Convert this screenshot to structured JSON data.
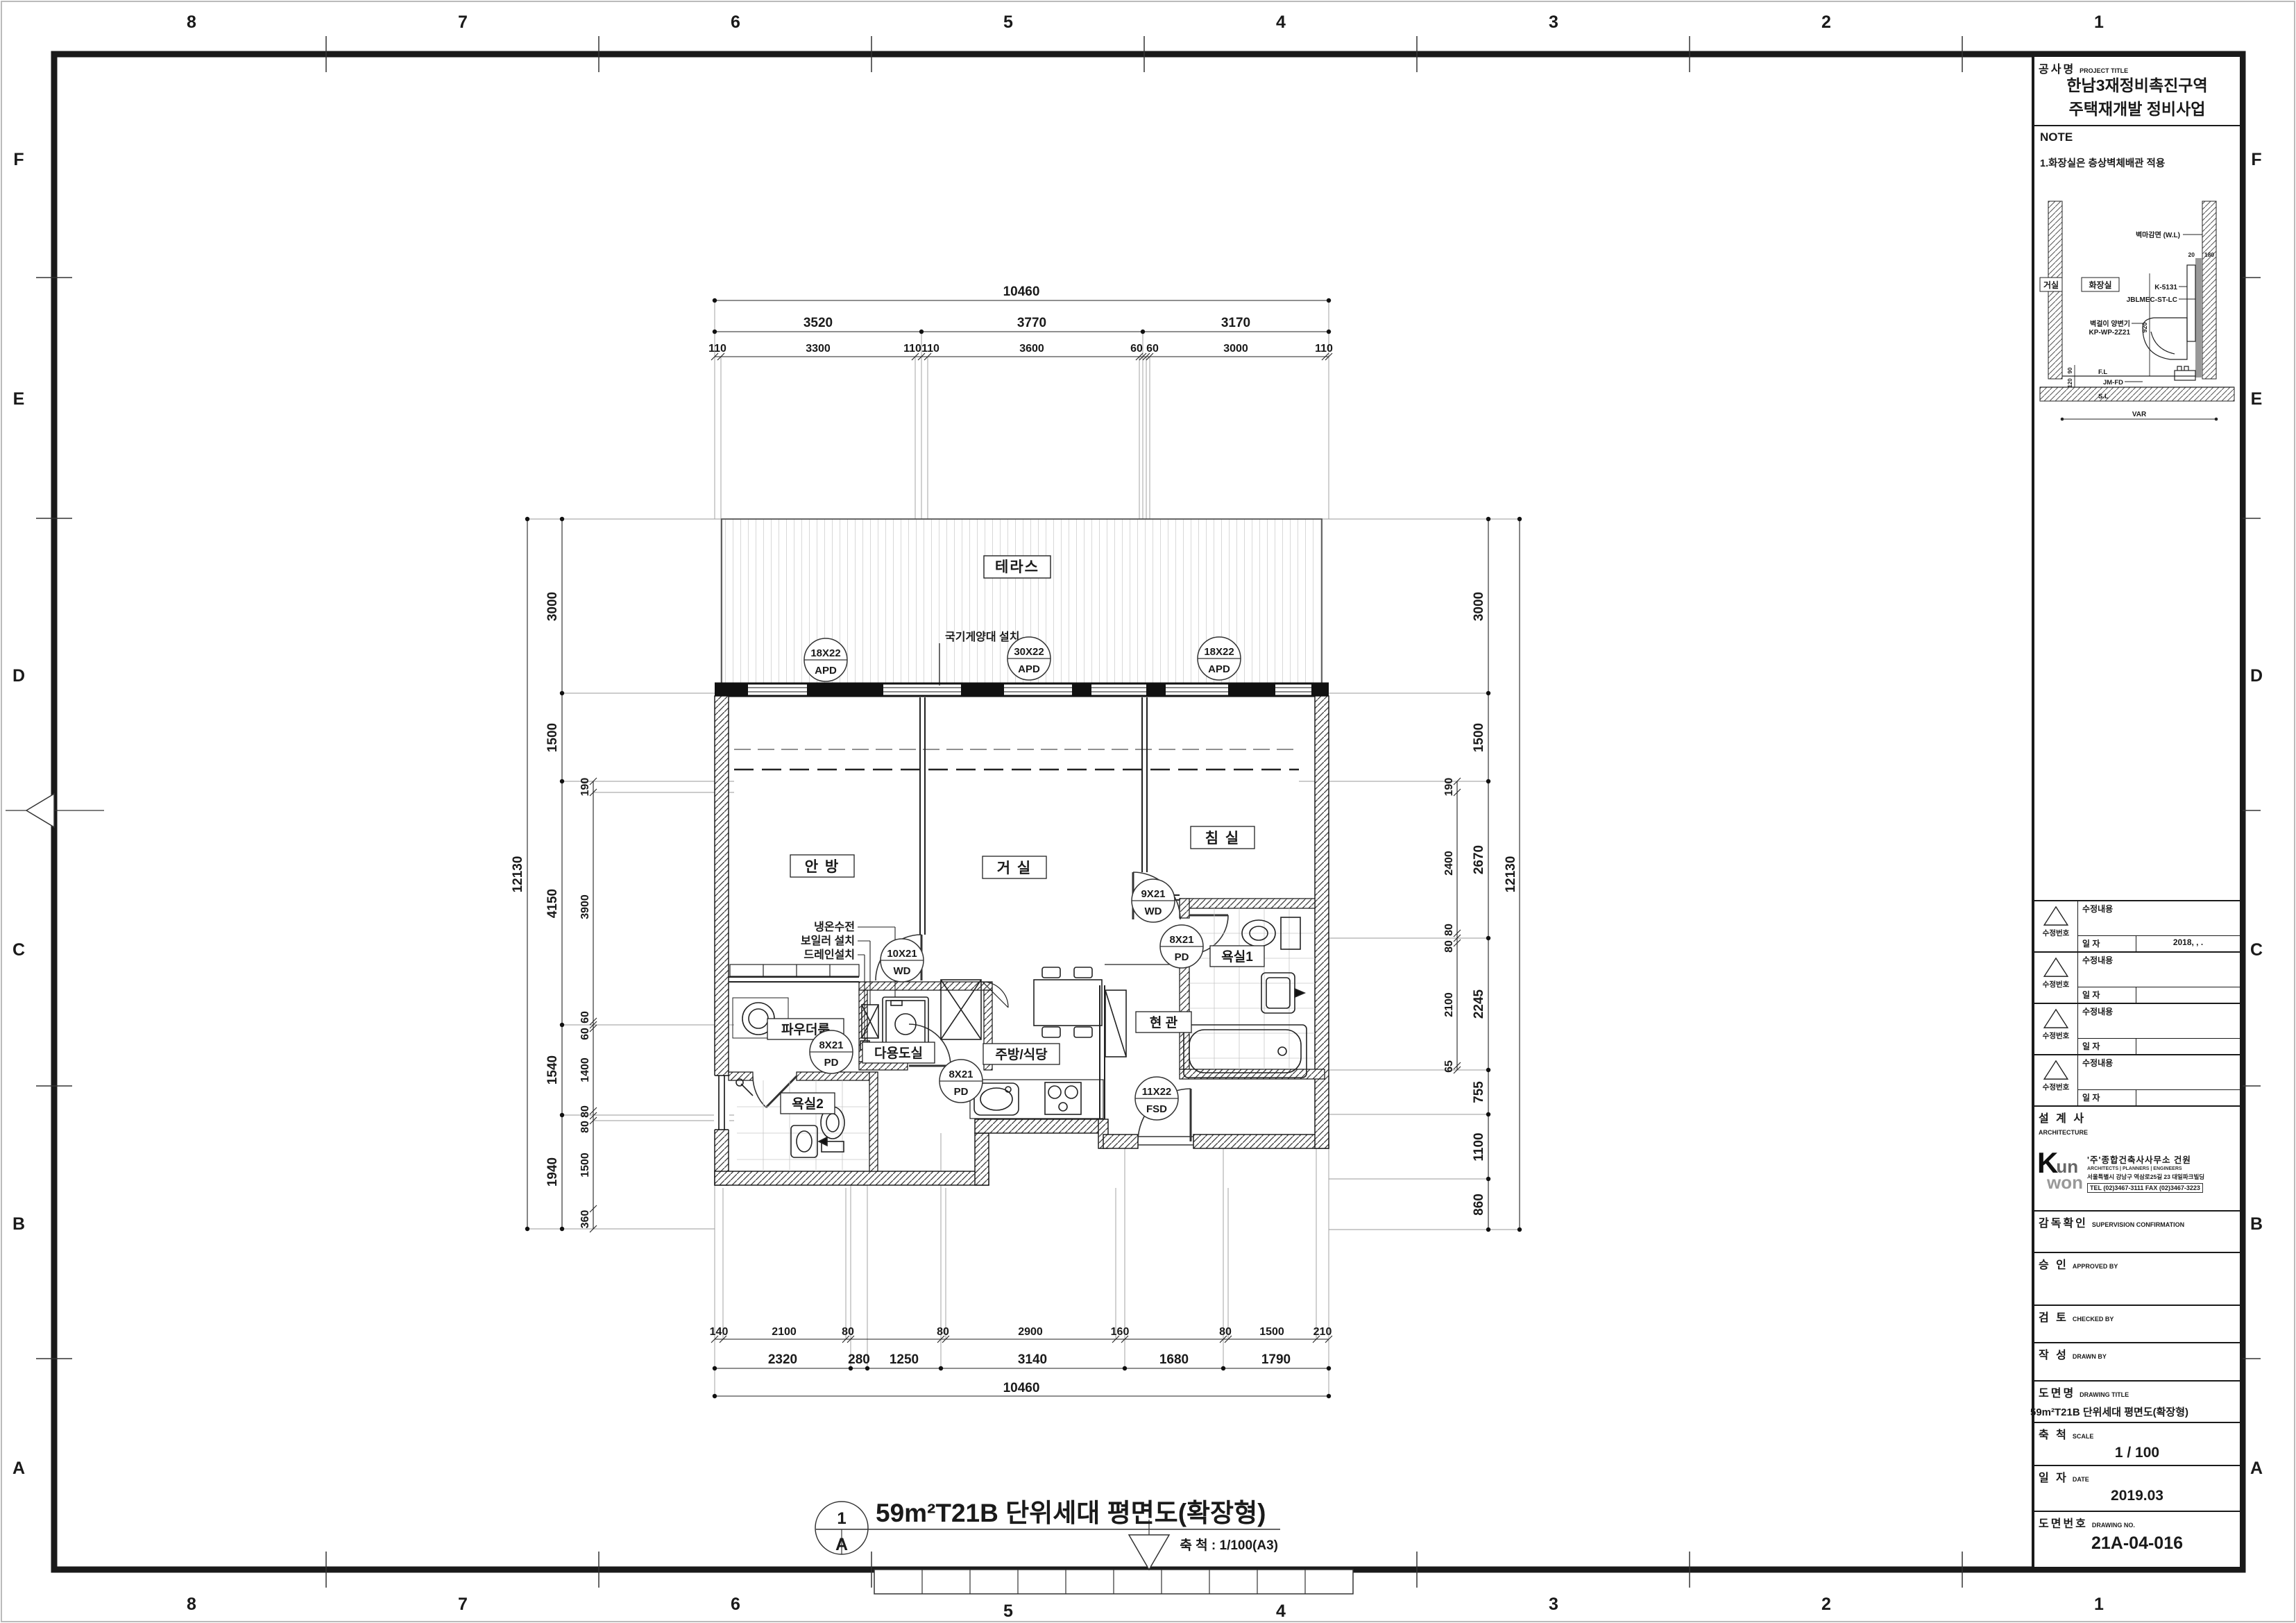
{
  "sheet": {
    "bg": "#ffffff",
    "line": "#1a1a1a"
  },
  "grid": {
    "cols": [
      "8",
      "7",
      "6",
      "5",
      "4",
      "3",
      "2",
      "1"
    ],
    "rows": [
      "F",
      "E",
      "D",
      "C",
      "B",
      "A"
    ]
  },
  "plan": {
    "rooms": {
      "terrace": "테라스",
      "master": "안 방",
      "living": "거 실",
      "bedroom": "침 실",
      "bath1": "욕실1",
      "bath2": "욕실2",
      "entrance": "현 관",
      "kitchen": "주방/식당",
      "utility": "다용도실",
      "powder": "파우더룸"
    },
    "annotations": {
      "flagpole": "국기게양대 설치",
      "line1": "냉온수전",
      "line2": "보일러 설치",
      "line3": "드레인설치"
    },
    "tags": [
      {
        "size": "18X22",
        "type": "APD"
      },
      {
        "size": "30X22",
        "type": "APD"
      },
      {
        "size": "18X22",
        "type": "APD"
      },
      {
        "size": "10X21",
        "type": "WD"
      },
      {
        "size": "8X21",
        "type": "PD"
      },
      {
        "size": "8X21",
        "type": "PD"
      },
      {
        "size": "9X21",
        "type": "WD"
      },
      {
        "size": "8X21",
        "type": "PD"
      },
      {
        "size": "11X22",
        "type": "FSD"
      }
    ],
    "dims": {
      "t1": "10460",
      "t2": [
        "3520",
        "3770",
        "3170"
      ],
      "t3": [
        "110",
        "3300",
        "110",
        "110",
        "3600",
        "60",
        "60",
        "3000",
        "110"
      ],
      "b1": [
        "140",
        "2100",
        "80",
        "80",
        "2900",
        "160",
        "80",
        "1500",
        "210"
      ],
      "b2": [
        "2320",
        "280",
        "1250",
        "3140",
        "1680",
        "1790"
      ],
      "b3": "10460",
      "l1": "12130",
      "l2": [
        "3000",
        "1500",
        "4150",
        "1540",
        "1940"
      ],
      "l3": [
        "190",
        "3900",
        "60",
        "60",
        "1400",
        "80",
        "80",
        "1500",
        "360"
      ],
      "r1": [
        "190",
        "2400",
        "80",
        "80",
        "2100",
        "65"
      ],
      "r2": [
        "3000",
        "1500",
        "2670",
        "2245",
        "755",
        "1100",
        "860"
      ],
      "r3": "12130"
    }
  },
  "view": {
    "number": "1",
    "letter": "A",
    "title": "59m²T21B 단위세대 평면도(확장형)",
    "scale": "축 척 : 1/100(A3)"
  },
  "title_block": {
    "project_label": "공사명",
    "project_label_en": "PROJECT TITLE",
    "project_line1": "한남3재정비촉진구역",
    "project_line2": "주택재개발 정비사업",
    "note_label": "NOTE",
    "note_1": "1.화장실은 층상벽체배관 적용",
    "detail": {
      "room_left": "거실",
      "room_right": "화장실",
      "wall_finish": "벽마감면 (W.L)",
      "model_1": "K-5131",
      "model_2": "JBLMEC-ST-LC",
      "toilet_1": "벽걸이 양변기",
      "toilet_2": "KP-WP-2Z21",
      "fl": "F.L",
      "sl": "S.L",
      "drain": "JM-FD",
      "d20": "20",
      "d180": "180",
      "d920": "920",
      "d90": "90",
      "d120": "120",
      "dvar": "VAR"
    },
    "rev_no_label": "수정번호",
    "rev_content_label": "수정내용",
    "rev_date_label": "일  자",
    "rev_date_1": "2018,      ,      .",
    "architect_label": "설 계 사",
    "architect_en": "ARCHITECTURE",
    "firm_logo_k": "K",
    "firm_logo_un": "un",
    "firm_logo_won": "won",
    "firm_name": "'주'종합건축사사무소 건원",
    "firm_type": "ARCHITECTS   |   PLANNERS   |   ENGINEERS",
    "firm_addr": "서울특별시 강남구 역삼로25길 23 대일파크빌딩",
    "firm_tel": "TEL (02)3467-3111   FAX (02)3467-3223",
    "supervision_label": "감독확인",
    "supervision_en": "SUPERVISION CONFIRMATION",
    "approved_label": "승    인",
    "approved_en": "APPROVED BY",
    "checked_label": "검    토",
    "checked_en": "CHECKED BY",
    "drawn_label": "작    성",
    "drawn_en": "DRAWN BY",
    "title_label": "도면명",
    "title_en": "DRAWING TITLE",
    "title_value": "59m²T21B 단위세대 평면도(확장형)",
    "scale_label": "축    척",
    "scale_en": "SCALE",
    "scale_value": "1 / 100",
    "date_label": "일    자",
    "date_en": "DATE",
    "date_value": "2019.03",
    "no_label": "도면번호",
    "no_en": "DRAWING NO.",
    "no_value": "21A-04-016"
  }
}
